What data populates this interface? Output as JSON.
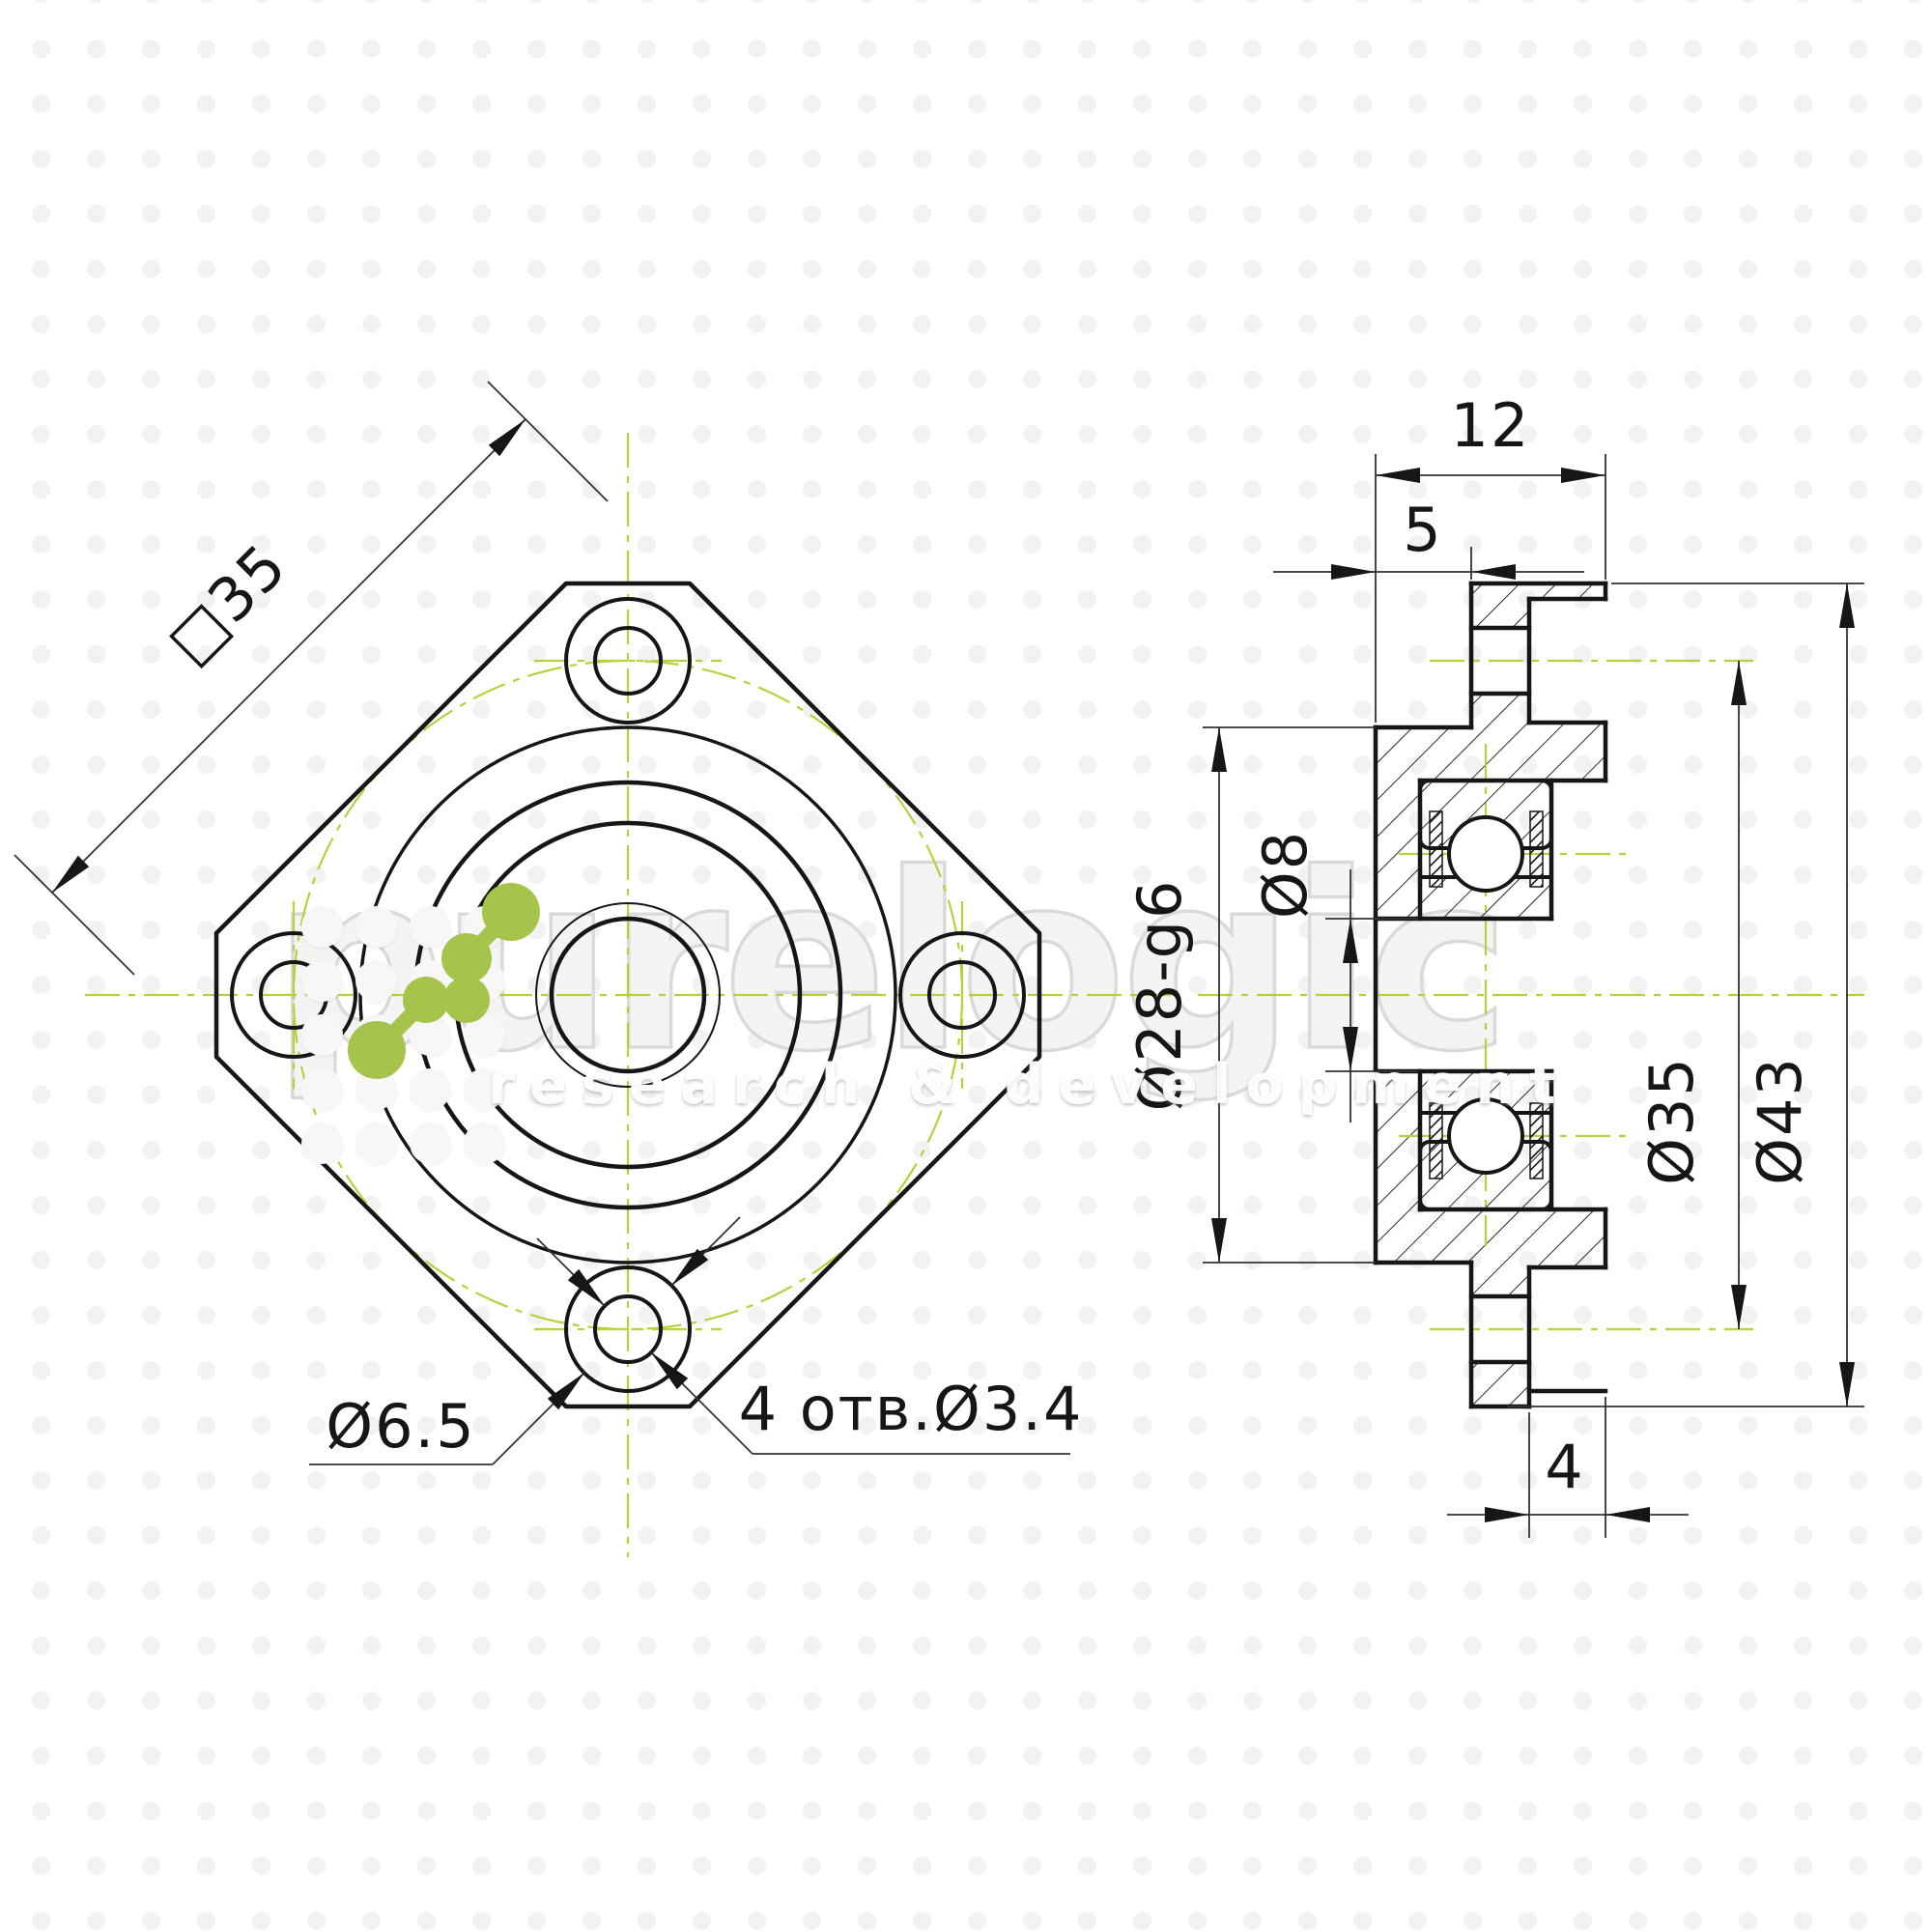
{
  "front_view": {
    "square_dim": "□35",
    "counterbore_dim": "Ø6.5",
    "holes_note": "4 отв.Ø3.4"
  },
  "section_view": {
    "width_dim": "12",
    "boss_length_dim": "5",
    "spigot_dim": "Ø28-g6",
    "bore_dim": "Ø8",
    "bolt_circle_dim": "Ø35",
    "flange_dim": "Ø43",
    "ear_thickness_dim": "4"
  },
  "watermark": {
    "brand": "purelogic",
    "tagline": "research & development"
  },
  "colors": {
    "line": "#161616",
    "centerline_green": "#b9cf3f",
    "logo_green": "#a6c44c",
    "watermark_gray": "#dadada"
  }
}
